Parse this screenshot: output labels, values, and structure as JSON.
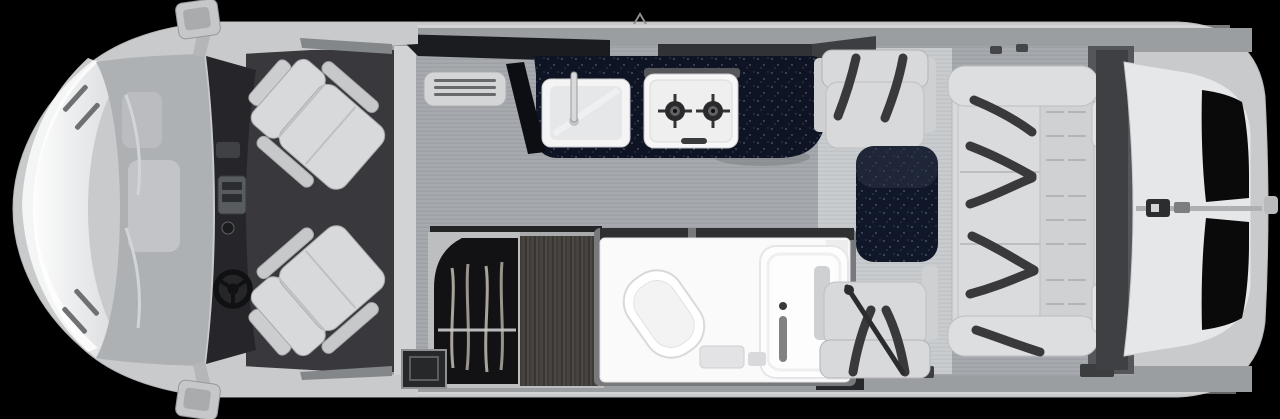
{
  "scene": {
    "type": "rv-motorhome-floor-plan",
    "view": "overhead-cutaway",
    "front_direction": "left"
  },
  "colors": {
    "background": "#000000",
    "body_shell": "#c9cacc",
    "wall": "#9b9ea1",
    "window_dark": "#1a1c20",
    "cab_floor": "#39393d",
    "dashboard": "#26262a",
    "windshield": "#aeb1b4",
    "seat": "#d8d9da",
    "belt": "#39393b",
    "galley_floor": "#a4a7ab",
    "dinette_mat": "#c8cbce",
    "countertop": "#0e1424",
    "table_top": "#101729",
    "sink": "#f4f4f5",
    "stove": "#f7f7f8",
    "burner": "#2a2a2c",
    "wardrobe_interior": "#121214",
    "cabinet_wood": "#44403d",
    "bathroom": "#fafafa",
    "rear_gap": "#3e4043",
    "rear_door": "#e6e7e9",
    "rear_window": "#0a0a0b",
    "mirror": "#c6c7c8"
  },
  "features": {
    "cab": {
      "swivel_seats": 2,
      "steering_wheel": 1,
      "side_mirrors": 2
    },
    "kitchen": {
      "sink": 1,
      "cooktop_burners": 2
    },
    "wardrobe": {
      "hangers": 4
    },
    "bathroom": {
      "toilet": 1,
      "shower": 1
    },
    "dinette": {
      "belted_seats": 2,
      "table": 1
    },
    "sofa": {
      "seatbelt_straps": 6,
      "headrests": 2
    },
    "rear": {
      "door_windows": 2
    }
  }
}
